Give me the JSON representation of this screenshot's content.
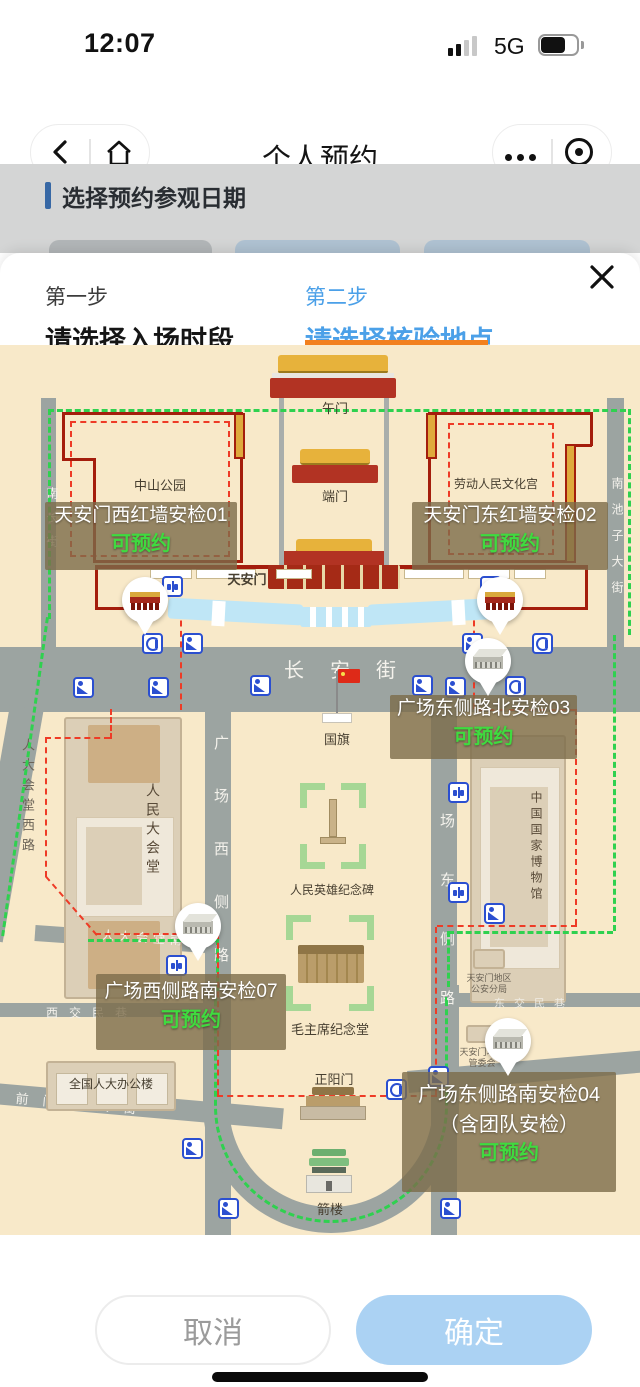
{
  "status_bar": {
    "time": "12:07",
    "network": "5G"
  },
  "nav": {
    "title": "个人预约"
  },
  "page": {
    "section_title": "选择预约参观日期"
  },
  "sheet": {
    "step1": {
      "label": "第一步",
      "title": "请选择入场时段"
    },
    "step2": {
      "label": "第二步",
      "title": "请选择核验地点"
    }
  },
  "map": {
    "labels": {
      "wumen": "午门",
      "duanmen": "端门",
      "zhongshan_park": "中山公园",
      "cultural_palace": "劳动人民文化宫",
      "tiananmen": "天安门",
      "changan_street": "长安街",
      "national_flag": "国旗",
      "great_hall": "人民大会堂",
      "heroes_monument": "人民英雄纪念碑",
      "national_museum": "中国国家博物馆",
      "mao_memorial": "毛主席纪念堂",
      "zhengyangmen": "正阳门",
      "jianlou": "箭楼",
      "npc_office": "全国人大办公楼",
      "qianmen_west_street": "前门西大街",
      "xijiaominxiang": "西交民巷",
      "dongjiaominxiang": "东交民巷",
      "rdht_south_street": "人大会堂南",
      "rdht_west_road": "人大会堂西路",
      "nanchizi_street": "南池子大街",
      "nanchang_street": "南长街",
      "square_west_road": "广场西侧路",
      "square_east_road": "场东侧路",
      "police_line1": "天安门地区",
      "police_line2": "公安分局",
      "committee_line1": "天安门地区",
      "committee_line2": "管委会"
    },
    "checkpoints": [
      {
        "name": "天安门西红墙安检01",
        "status": "可预约"
      },
      {
        "name": "天安门东红墙安检02",
        "status": "可预约"
      },
      {
        "name": "广场东侧路北安检03",
        "status": "可预约"
      },
      {
        "name": "广场西侧路南安检07",
        "status": "可预约"
      },
      {
        "name": "广场东侧路南安检04",
        "name_line2": "（含团队安检）",
        "status": "可预约"
      }
    ]
  },
  "footer": {
    "cancel": "取消",
    "confirm": "确定"
  },
  "colors": {
    "accent_blue": "#4BA0E8",
    "accent_orange": "#F2801E",
    "status_green": "#3FDB3F",
    "map_bg": "#F8E9C9",
    "road": "#9CA4A1",
    "wall_red": "#A41D0C",
    "dash_green": "#2FD14F",
    "dash_red": "#EE3B26",
    "label_box": "rgba(124,108,74,0.8)"
  }
}
